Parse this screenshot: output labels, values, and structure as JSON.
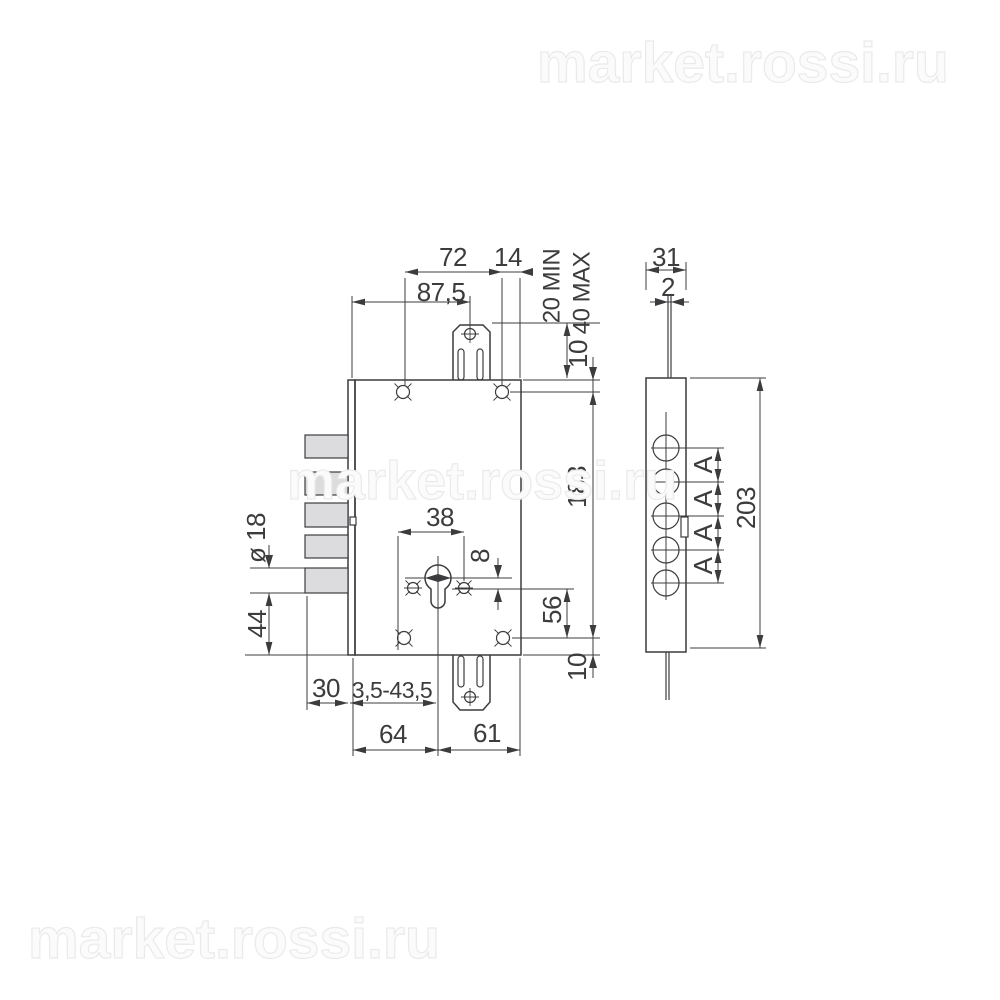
{
  "watermarks": {
    "top_right": "market.rossi.ru",
    "center": "market.rossi.ru",
    "bottom_left": "market.rossi.ru"
  },
  "front_view": {
    "dim_87_5": "87,5",
    "dim_72": "72",
    "dim_14": "14",
    "dim_20_min": "20 MIN",
    "dim_40_max": "40 MAX",
    "dim_10_top": "10",
    "dim_183": "183",
    "dim_38": "38",
    "dim_8": "8",
    "dim_56": "56",
    "dim_10_bottom": "10",
    "dim_dia_18": "ø 18",
    "dim_44": "44",
    "dim_30": "30",
    "dim_3_5_43_5": "3,5-43,5",
    "dim_64": "64",
    "dim_61": "61"
  },
  "side_view": {
    "dim_31": "31",
    "dim_2": "2",
    "dim_203": "203",
    "dim_a_1": "A",
    "dim_a_2": "A",
    "dim_a_3": "A",
    "dim_a_4": "A"
  },
  "colors": {
    "line": "#3c3c3e",
    "body_fill": "#dcdcde",
    "watermark": "#fbfbfb"
  }
}
